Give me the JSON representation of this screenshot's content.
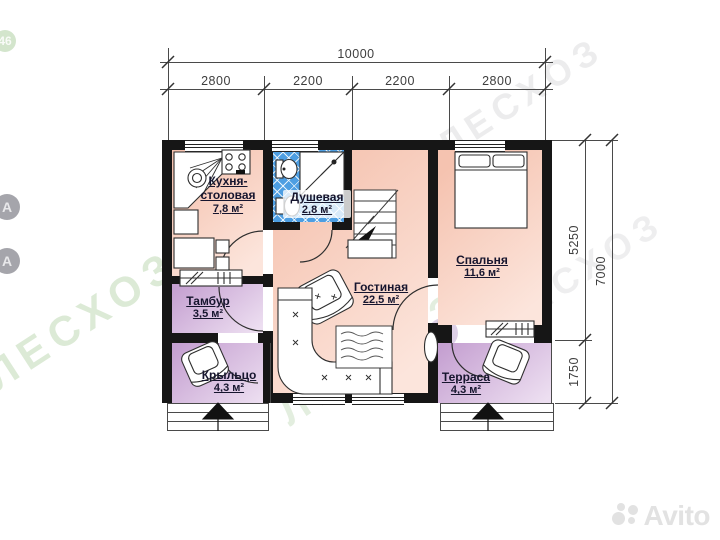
{
  "dimensions": {
    "top": {
      "total": "10000",
      "segments": [
        "2800",
        "2200",
        "2200",
        "2800"
      ]
    },
    "right": {
      "segments": [
        "5250",
        "1750"
      ],
      "total": "7000"
    }
  },
  "rooms": {
    "kitchen": {
      "name_line1": "Кухня-",
      "name_line2": "столовая",
      "area": "7,8 м²"
    },
    "shower": {
      "name": "Душевая",
      "area": "2,8 м²"
    },
    "bedroom": {
      "name": "Спальня",
      "area": "11,6 м²"
    },
    "living": {
      "name": "Гостиная",
      "area": "22,5 м²"
    },
    "tambur": {
      "name": "Тамбур",
      "area": "3,5 м²"
    },
    "porch": {
      "name": "Крыльцо",
      "area": "4,3 м²"
    },
    "terrace": {
      "name": "Терраса",
      "area": "4,3 м²"
    }
  },
  "watermark": {
    "brand": "ЛЕСХОЗ",
    "badge": "46",
    "letter": "А"
  },
  "branding": {
    "site": "Avito"
  },
  "colors": {
    "wall": "#161616",
    "line": "#4a4a4a",
    "dim_text": "#3e3e3e",
    "label": "#16152e",
    "floor_warm": "#f5c3b0",
    "floor_warm_light": "#fce5dc",
    "floor_cool": "#c5a0d1",
    "floor_cool_light": "#eddff1",
    "tile_blue": "#4d9ee2",
    "watermark_green": "#8cb978",
    "watermark_purple": "#9a72b5",
    "avito_gray": "#e2e2e2"
  }
}
